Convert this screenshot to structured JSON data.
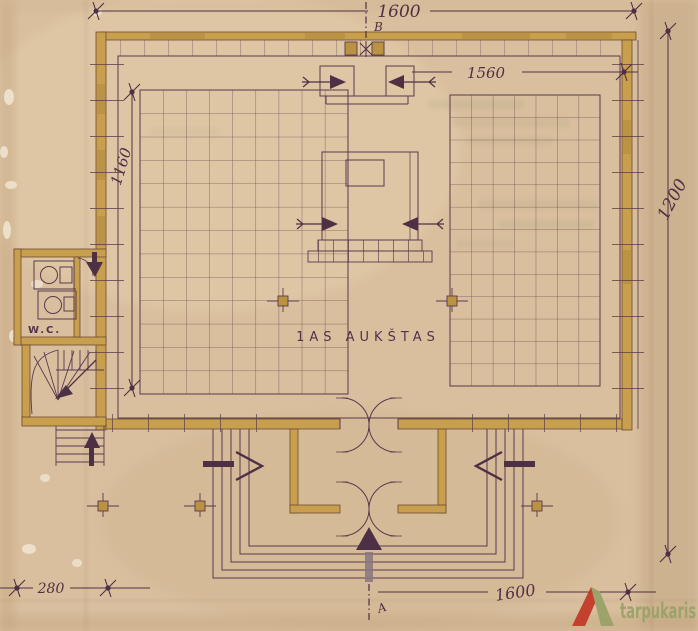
{
  "plan": {
    "floor_label": "1AS AUKŠTAS",
    "wc_label": "W.C.",
    "axis_top_label": "B",
    "axis_bottom_label": "A",
    "dim_top": "1600",
    "dim_inner": "1560",
    "dim_left": "1160",
    "dim_right": "1200",
    "dim_bottom_left": "280",
    "dim_bottom_right": "1600"
  },
  "watermark": {
    "brand": "tarpukaris"
  },
  "colors": {
    "paper": "#d9bf9e",
    "ink": "#583a4e",
    "wall_fill": "#c89f4c",
    "wall_dark": "#bb9142",
    "handwriting": "#532f47",
    "logo_red": "#c23a28",
    "logo_green": "#9aa26a"
  }
}
